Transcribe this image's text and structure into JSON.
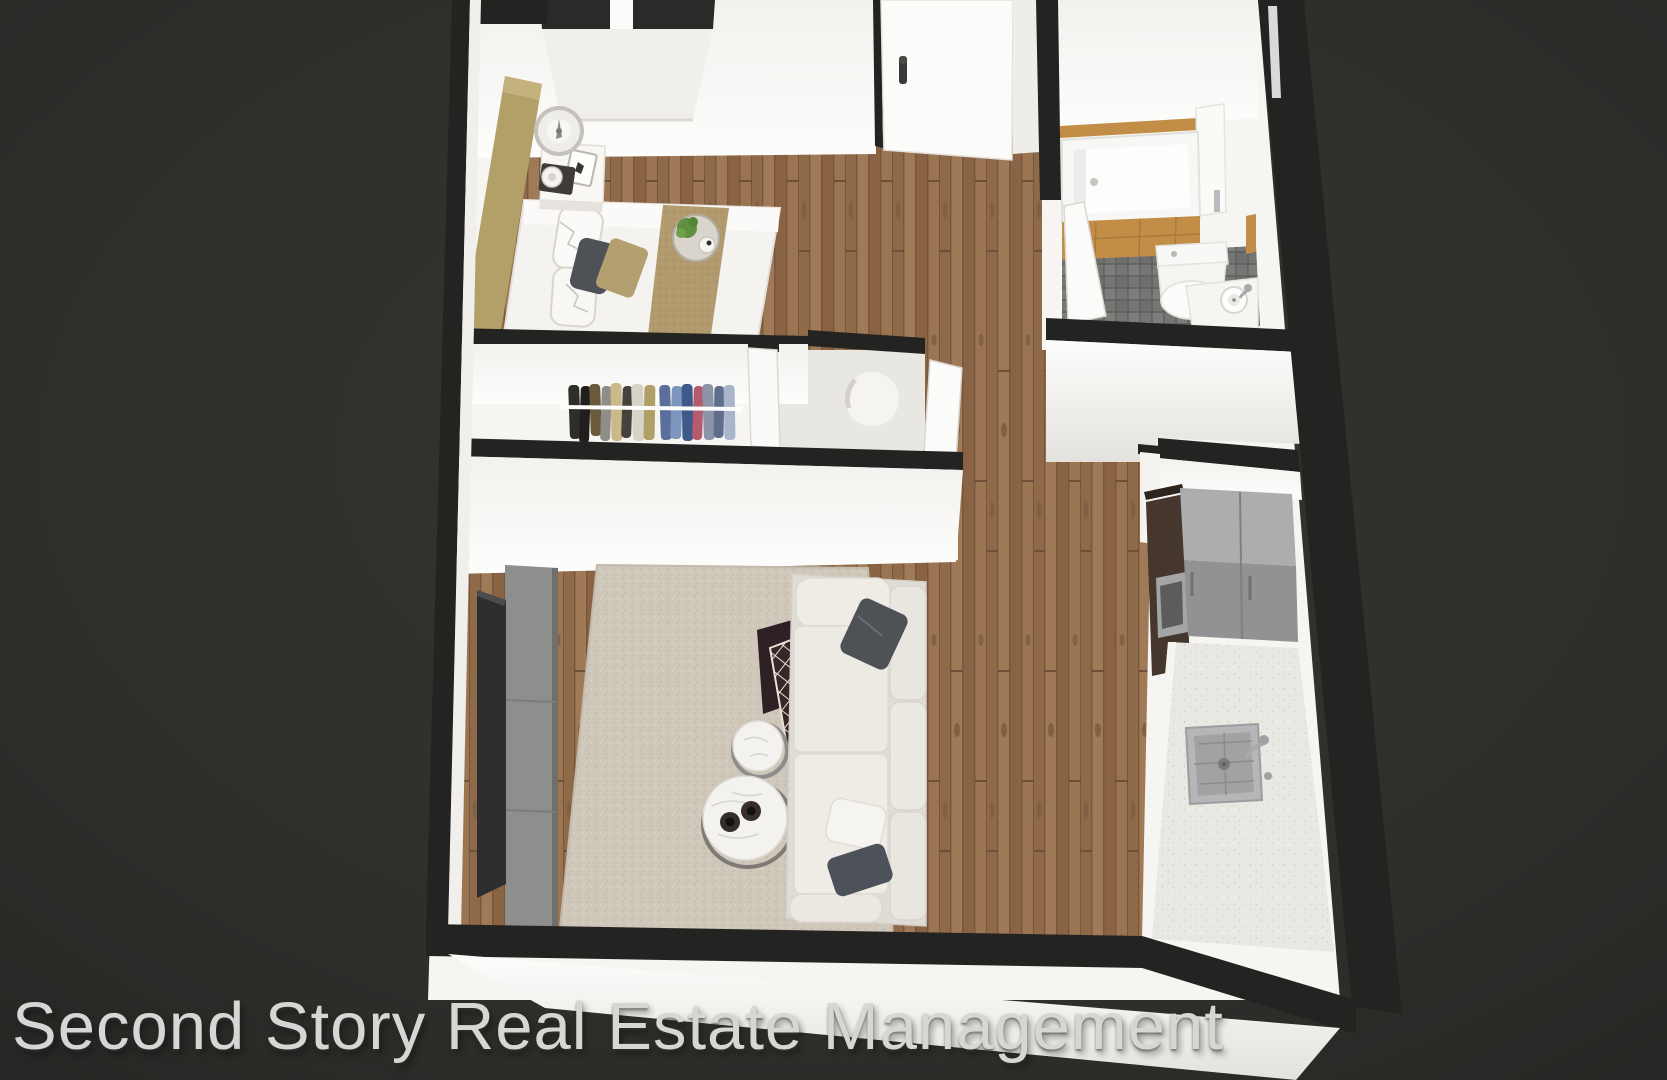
{
  "watermark": {
    "text": "Second Story Real Estate Management"
  },
  "palette": {
    "bg": "#2e2e2b",
    "bgEdge": "#262624",
    "wallTop": "#232322",
    "wallFace": "#f6f5f2",
    "wallFaceDeep": "#e7e5e1",
    "wood": "#97714e",
    "woodDark": "#7a5a3e",
    "tile": "#767674",
    "grout": "#5e5e5c",
    "rug": "#cfc7ba",
    "tan": "#b3a069",
    "runner": "#b19a6d",
    "oak": "#c28d46",
    "sofa": "#e9e6df",
    "sofaBase": "#dfdcd5",
    "pillowDark": "#4e5257",
    "tv": "#2c2e30",
    "console": "#8e8e8c",
    "marble": "#f3f2ef",
    "counter": "#eae8e2",
    "fridgeTop": "#abadaf",
    "fridgeFront": "#909294",
    "cabinet": "#45372d",
    "steel": "#b4b6b8",
    "throw": "#372528",
    "plant": "#5f8f3f",
    "doorWhite": "#fbfbf9",
    "glass": "#2b2a28",
    "watermark": "#d7d6d4"
  },
  "scene": {
    "type": "3d-dollhouse-floor-plan-render",
    "rooms": [
      "bedroom",
      "closet",
      "utility-niche",
      "bathroom",
      "hallway",
      "living-room",
      "kitchen"
    ],
    "furniture": {
      "bedroom": [
        "double-bed",
        "headboard",
        "nightstand",
        "table-lamp",
        "picture-frame",
        "breakfast-tray",
        "window"
      ],
      "closet": [
        "clothes-rod",
        "hanging-clothes"
      ],
      "utility-niche": [
        "water-heater-cylinder"
      ],
      "bathroom": [
        "bathtub",
        "toilet",
        "vanity-sink",
        "door"
      ],
      "living-room": [
        "tv",
        "media-console",
        "area-rug",
        "sofa",
        "throw-blanket",
        "coffee-table-large",
        "coffee-table-small",
        "cups"
      ],
      "kitchen": [
        "refrigerator",
        "tall-cabinet",
        "microwave",
        "counter",
        "sink",
        "faucet"
      ],
      "hallway": [
        "entry-door"
      ]
    }
  }
}
